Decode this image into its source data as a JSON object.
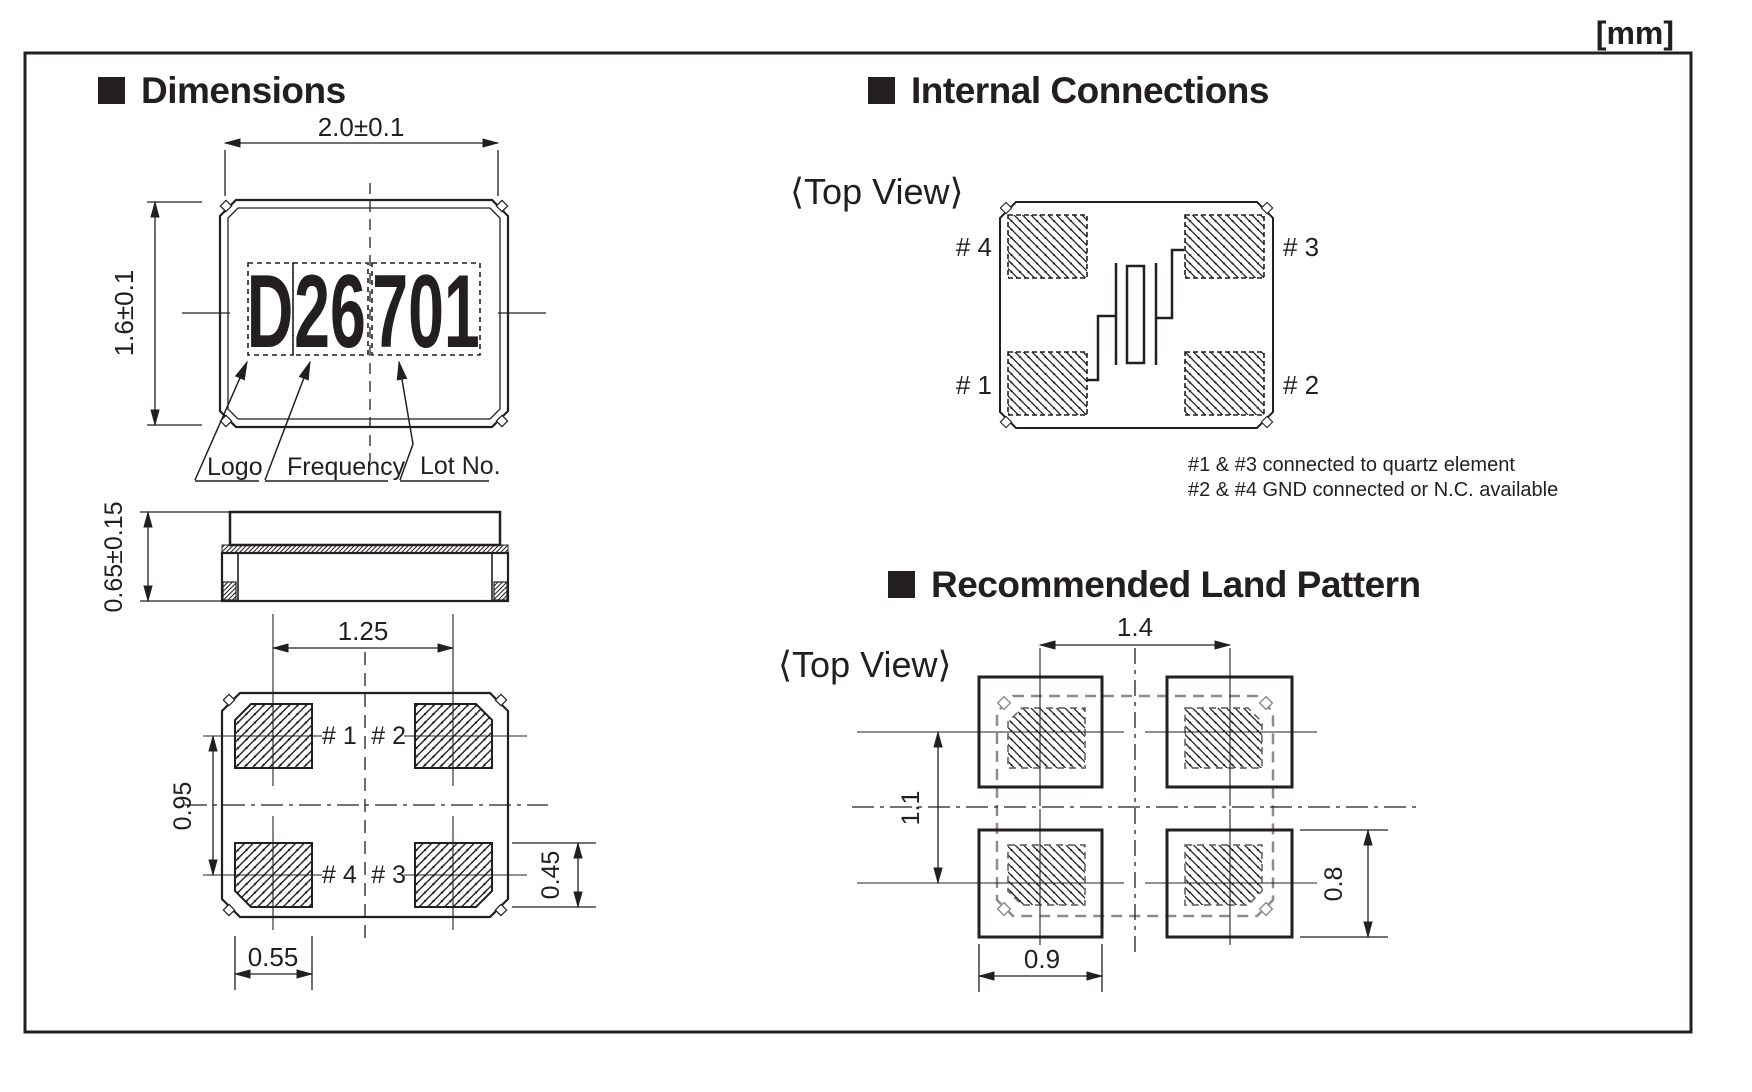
{
  "unit_label": "[mm]",
  "colors": {
    "ink": "#231f20",
    "land_outline_gray": "#8c8c8c"
  },
  "dimensions_section": {
    "title": "Dimensions",
    "marking": {
      "logo": "D",
      "frequency": "26",
      "lot": "701"
    },
    "marking_labels": {
      "logo": "Logo",
      "frequency": "Frequency",
      "lot": "Lot No."
    },
    "top_view_dims": {
      "width": "2.0±0.1",
      "height": "1.6±0.1"
    },
    "side_view_dims": {
      "thickness": "0.65±0.15"
    },
    "bottom_view_dims": {
      "pad_pitch_x": "1.25",
      "pad_pitch_y": "0.95",
      "pad_height": "0.45",
      "pad_width": "0.55"
    },
    "pad_labels": {
      "p1": "# 1",
      "p2": "# 2",
      "p3": "# 3",
      "p4": "# 4"
    }
  },
  "internal_section": {
    "title": "Internal Connections",
    "view_label": "⟨Top View⟩",
    "pin_labels": {
      "p1": "# 1",
      "p2": "# 2",
      "p3": "# 3",
      "p4": "# 4"
    },
    "notes": {
      "line1": "#1 & #3 connected to quartz element",
      "line2": "#2 & #4 GND connected or N.C. available"
    }
  },
  "land_section": {
    "title": "Recommended Land Pattern",
    "view_label": "⟨Top View⟩",
    "dims": {
      "pitch_x": "1.4",
      "pitch_y": "1.1",
      "pad_width": "0.9",
      "pad_height": "0.8"
    }
  }
}
